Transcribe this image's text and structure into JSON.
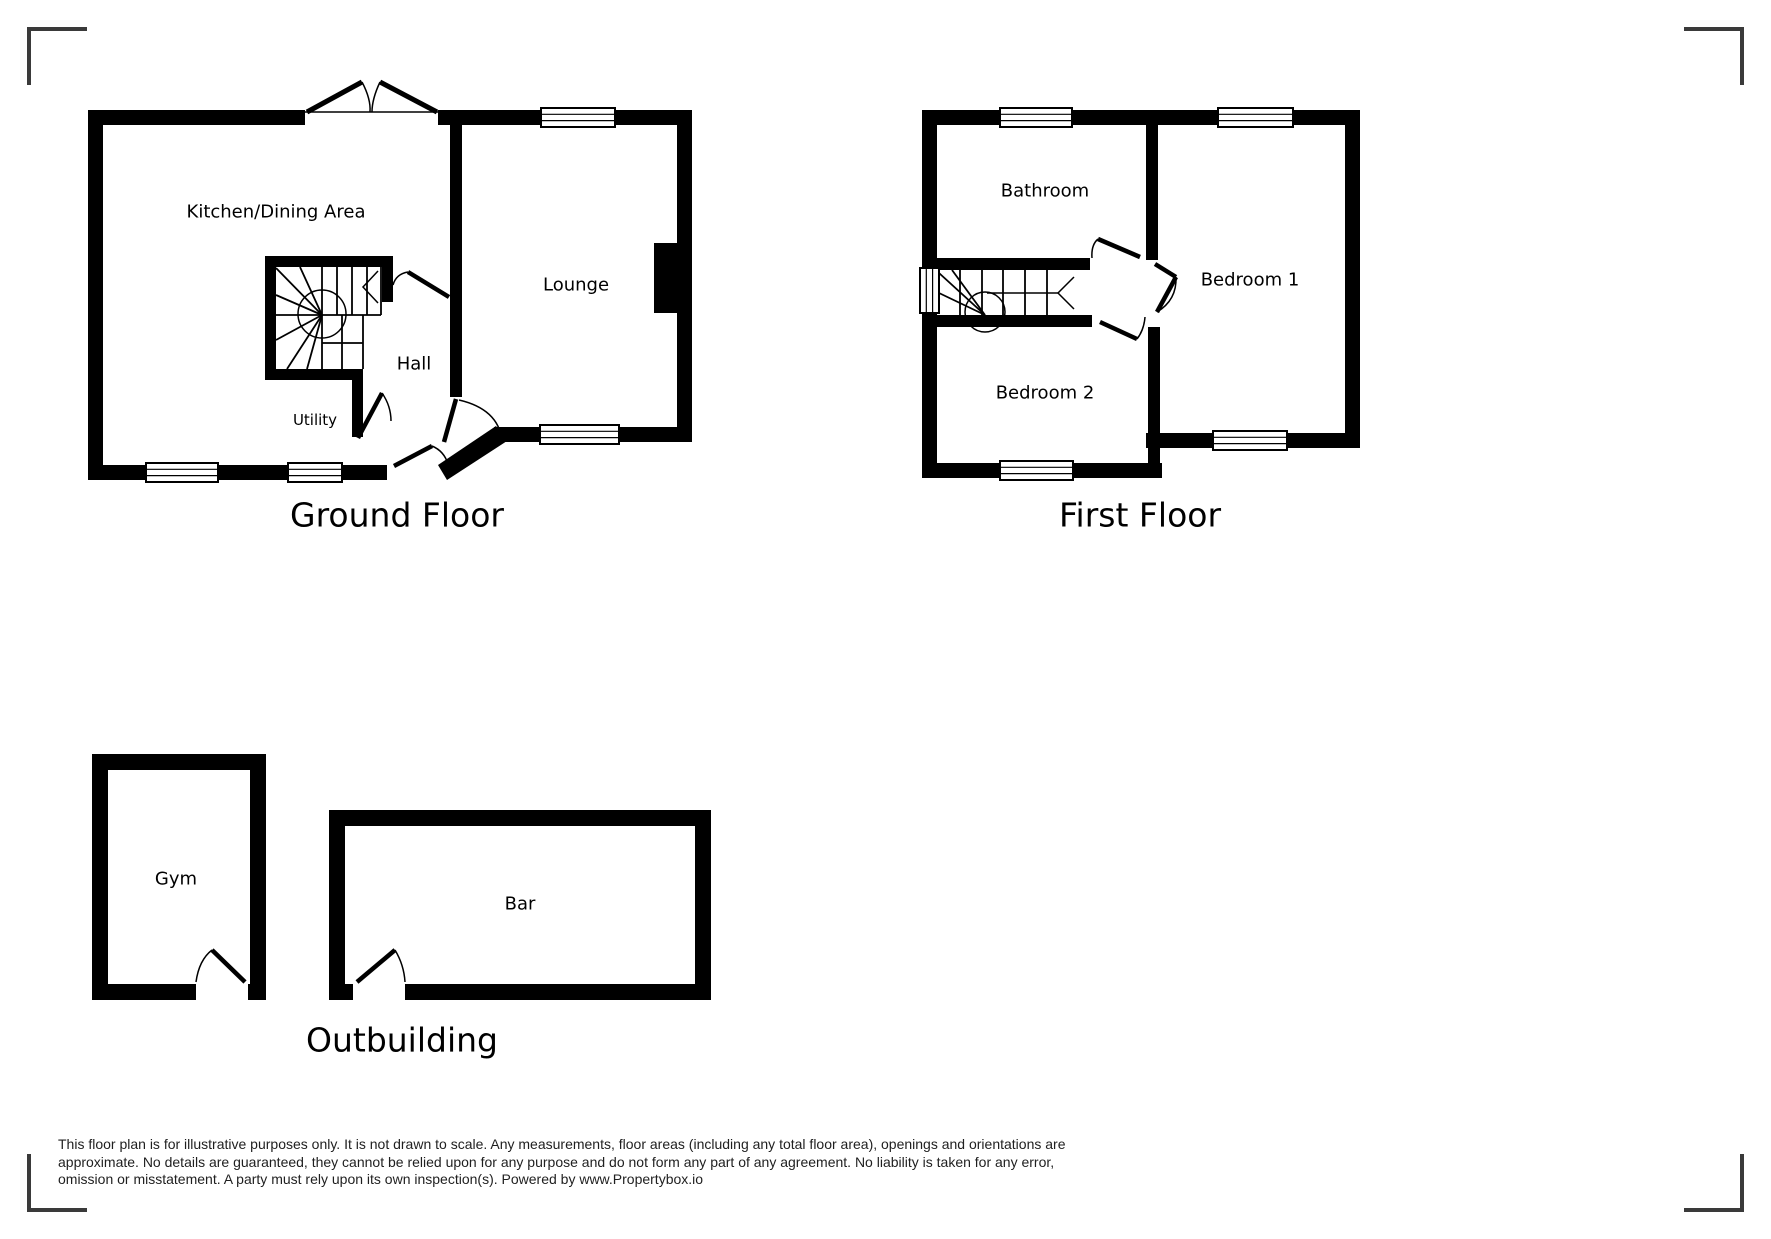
{
  "ground_floor": {
    "title": "Ground Floor",
    "rooms": {
      "kitchen": "Kitchen/Dining Area",
      "lounge": "Lounge",
      "hall": "Hall",
      "utility": "Utility"
    }
  },
  "first_floor": {
    "title": "First Floor",
    "rooms": {
      "bathroom": "Bathroom",
      "bedroom1": "Bedroom 1",
      "bedroom2": "Bedroom 2"
    }
  },
  "outbuilding": {
    "title": "Outbuilding",
    "rooms": {
      "gym": "Gym",
      "bar": "Bar"
    }
  },
  "disclaimer": {
    "lines": [
      "This floor plan is for illustrative purposes only. It is not drawn to scale. Any measurements, floor areas (including any total floor area), openings and orientations are",
      "approximate. No details are guaranteed, they cannot be relied upon for any purpose and do not form any part of any agreement. No liability is taken for any error,",
      "omission or misstatement. A party must rely upon its own inspection(s). Powered by www.Propertybox.io"
    ]
  },
  "colors": {
    "wall": "#000000",
    "line": "#000000",
    "corner_mark": "#3a3a3a",
    "text": "#000000",
    "disclaimer_text": "#1f1f1f",
    "background": "#ffffff"
  }
}
